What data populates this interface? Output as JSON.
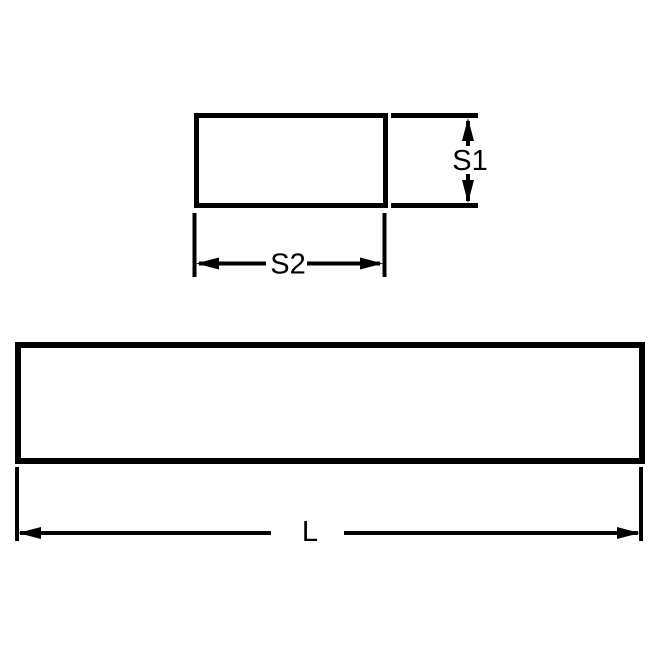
{
  "diagram": {
    "background": "#ffffff",
    "line_color": "#000000",
    "views": {
      "cross_section": {
        "name": "rectangular cross-section end view",
        "dimensions": {
          "height": {
            "label": "S1"
          },
          "width": {
            "label": "S2"
          }
        }
      },
      "side": {
        "name": "bar side view",
        "dimensions": {
          "length": {
            "label": "L"
          }
        }
      }
    }
  }
}
